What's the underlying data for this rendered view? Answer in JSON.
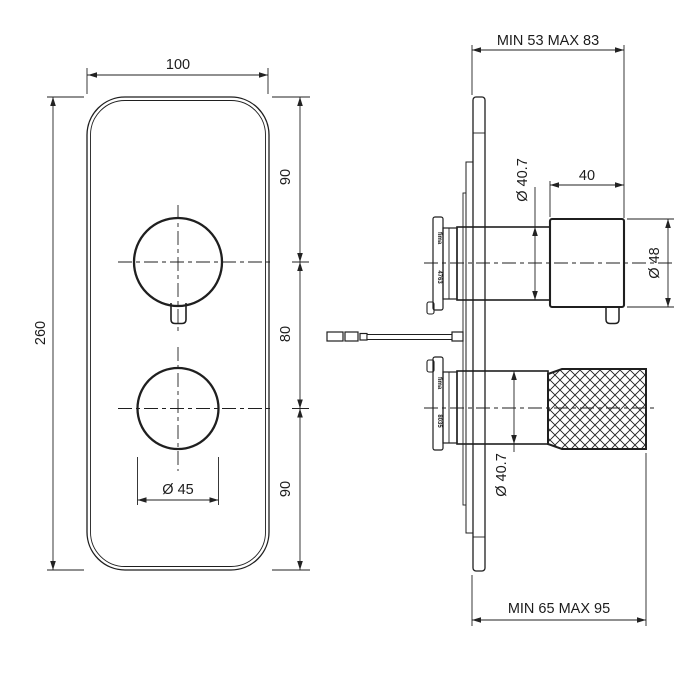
{
  "drawing": {
    "type": "technical-dimension-drawing",
    "subject": "concealed thermostatic shower mixer, front view and side section view",
    "colors": {
      "line": "#1f1f1f",
      "background": "#ffffff"
    },
    "front_view": {
      "plate_width_dim": "100",
      "plate_height_dim": "260",
      "top_to_upper_handle_dim": "90",
      "handle_to_handle_dim": "80",
      "lower_handle_to_bottom_dim": "90",
      "lower_knob_diameter_dim": "Ø 45"
    },
    "side_view": {
      "upper_depth_dim": "MIN 53 MAX 83",
      "lower_depth_dim": "MIN 65 MAX 95",
      "handle_length_dim": "40",
      "handle_diameter_dim": "Ø 48",
      "upper_body_diameter_dim": "Ø 40.7",
      "lower_body_diameter_dim": "Ø 40.7",
      "upper_cartridge": {
        "brand": "fima",
        "code": "4763"
      },
      "lower_cartridge": {
        "brand": "fima",
        "code": "8035"
      }
    }
  }
}
